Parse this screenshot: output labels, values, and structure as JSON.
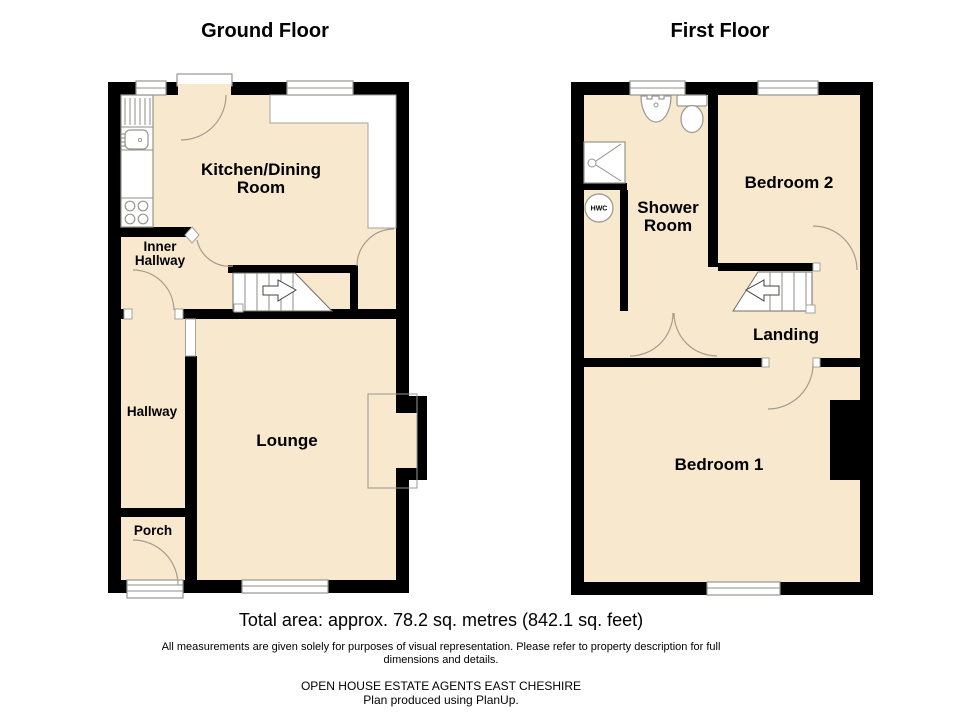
{
  "ground_floor": {
    "title": "Ground Floor",
    "rooms": {
      "kitchen_line1": "Kitchen/Dining",
      "kitchen_line2": "Room",
      "inner_hallway_line1": "Inner",
      "inner_hallway_line2": "Hallway",
      "hallway": "Hallway",
      "lounge": "Lounge",
      "porch": "Porch"
    }
  },
  "first_floor": {
    "title": "First Floor",
    "rooms": {
      "shower_line1": "Shower",
      "shower_line2": "Room",
      "bedroom2": "Bedroom 2",
      "landing": "Landing",
      "bedroom1": "Bedroom 1"
    },
    "fixtures": {
      "hwc": "HWC"
    }
  },
  "footer": {
    "total_area": "Total area: approx. 78.2 sq. metres (842.1 sq. feet)",
    "disclaimer_line1": "All measurements are given solely for purposes of visual representation. Please refer to property description for full",
    "disclaimer_line2": "dimensions and details.",
    "agent": "OPEN HOUSE ESTATE AGENTS EAST CHESHIRE",
    "produced": "Plan produced using PlanUp."
  },
  "colors": {
    "room_fill": "#F8E8CE",
    "wall": "#000000",
    "detail_line": "#A3A39B",
    "text": "#000000"
  }
}
